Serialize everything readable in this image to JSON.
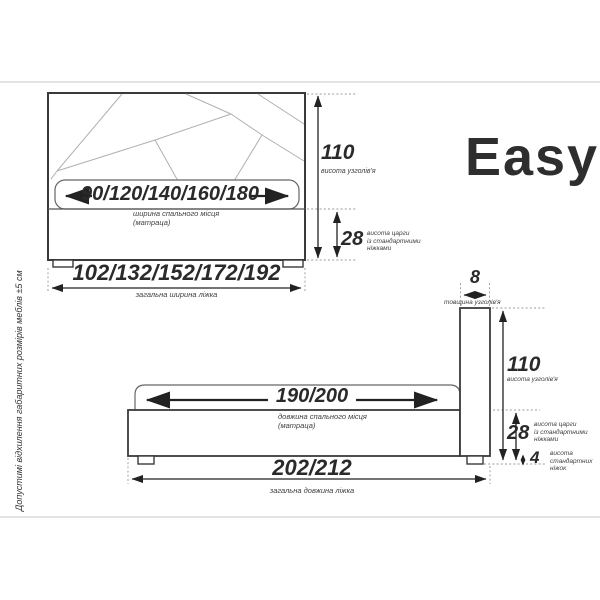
{
  "brand": {
    "name": "Easy"
  },
  "note_vertical": "Допустимі відхилення габаритних розмірів меблів ±5 см",
  "colors": {
    "outline": "#3a3a3a",
    "dimension": "#222222",
    "pattern": "#b0b0b0",
    "dotted": "#999999",
    "divider": "#c9c9c9"
  },
  "front_view": {
    "mattress_width": "90/120/140/160/180",
    "mattress_label_line1": "ширина спального місця",
    "mattress_label_line2": "(матраца)",
    "total_width": "102/132/152/172/192",
    "total_width_label": "загальна ширина ліжка",
    "headboard_height": "110",
    "headboard_height_label": "висота узголів'я",
    "rail_height": "28",
    "rail_height_label_line1": "висота царги",
    "rail_height_label_line2": "із стандартними",
    "rail_height_label_line3": "ніжками"
  },
  "side_view": {
    "mattress_length": "190/200",
    "mattress_label_line1": "довжина спального місця",
    "mattress_label_line2": "(матраца)",
    "total_length": "202/212",
    "total_length_label": "загальна довжина ліжка",
    "headboard_thickness": "8",
    "headboard_thickness_label": "товщина узголів'я",
    "headboard_height": "110",
    "headboard_height_label": "висота узголів'я",
    "rail_height": "28",
    "rail_height_label_line1": "висота царги",
    "rail_height_label_line2": "із стандартними",
    "rail_height_label_line3": "ніжками",
    "leg_height": "4",
    "leg_height_label_line1": "висота",
    "leg_height_label_line2": "стандартних",
    "leg_height_label_line3": "ніжок"
  }
}
